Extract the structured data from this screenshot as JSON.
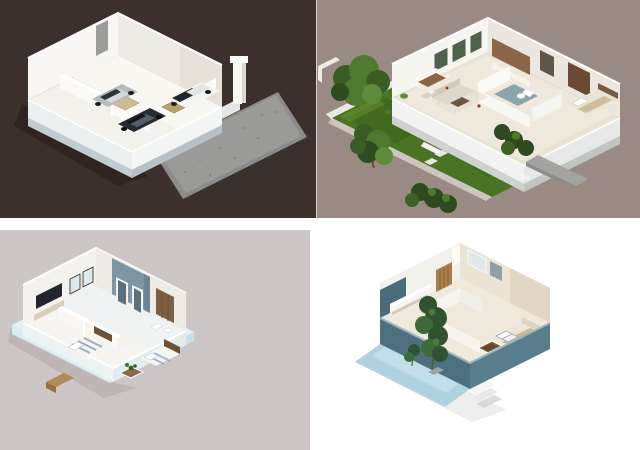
{
  "page": {
    "kind": "collage-of-3d-floor-plan-renderings",
    "background": "#ffffff",
    "width": 640,
    "height": 450,
    "visible_text": ""
  },
  "layout": {
    "rows": 2,
    "columns": 2,
    "gap_color": "#ffffff"
  },
  "panels": [
    {
      "id": "top-left",
      "name": "garage-floor-plan",
      "description": "3D isometric floor plan of a garage level with three parked cars, white walls, a tall white pillar and a speckled concrete driveway on a dark brown backdrop",
      "background": "#3b302c",
      "accents": {
        "driveway": "#8c8c8a",
        "walls": "#f8f6f2",
        "floor": "#f2f1eb",
        "car_silver": "#b6babd",
        "car_dark": "#262b31",
        "car_white": "#f3f3f0",
        "mat": "#cdbc92"
      }
    },
    {
      "id": "top-right",
      "name": "house-with-lawn-floor-plan",
      "description": "3D isometric furnished house plan with sofa set, dining table, wooden kitchen, bathroom and bedroom, surrounded by a large green lawn, trees, bushes, steps and a grey walkway on a mauve-grey backdrop",
      "background": "#998b84",
      "accents": {
        "lawn": "#4a7423",
        "lawn_dark": "#3c611b",
        "walls": "#f7f5f0",
        "wood": "#8a6646",
        "path": "#a3a39f",
        "bed": "#e9e3d5"
      }
    },
    {
      "id": "bottom-left",
      "name": "apartment-floor-plan",
      "description": "3D isometric apartment plan on a pale icy-blue base with media wall and TV, dark framed windows, slate-blue accent room, wooden wardrobe, planter and two striped beds on a grey-pink backdrop",
      "background": "#cdc6c6",
      "accents": {
        "base": "#e4f2f6",
        "accent_wall": "#7e95a6",
        "wood": "#7b5e43",
        "stripe": "#7f9fc4",
        "walls": "#f4f2ee"
      }
    },
    {
      "id": "bottom-right",
      "name": "studio-floor-plan",
      "description": "3D isometric studio plan with teal perimeter walls, cream interior, wooden slat door, bathroom, bed with striped pillows, sunken brown floor pit, tall green plants and a pale blue terrace with steps on a white backdrop",
      "background": "#ffffff",
      "accents": {
        "wall_teal": "#4d7080",
        "wall_teal_light": "#587d8c",
        "floor": "#efe9dc",
        "terrace": "#aed3de",
        "wood": "#a97f4e",
        "pit": "#7a5c3c"
      }
    }
  ]
}
